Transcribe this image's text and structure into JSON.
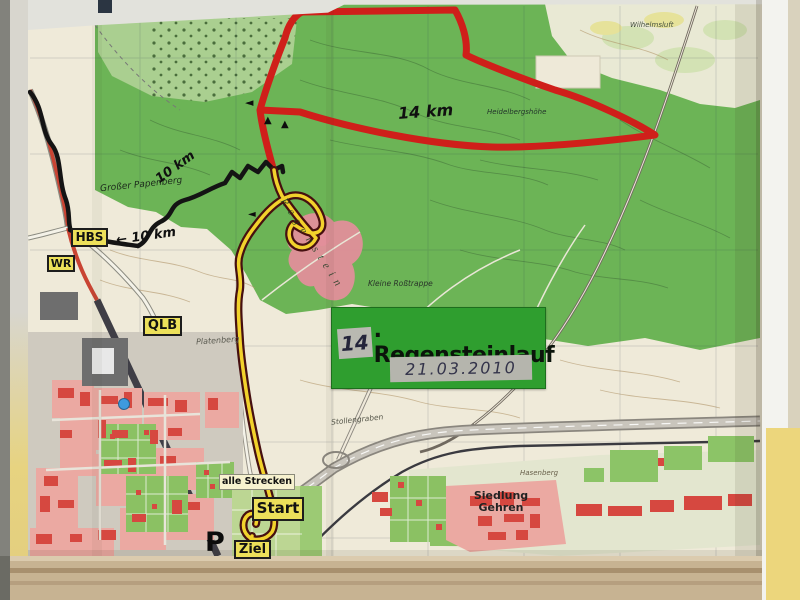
{
  "event_label": {
    "number": "14",
    "title_suffix": ". Regensteinlauf",
    "date": "21.03.2010"
  },
  "signs": {
    "hbs": "HBS",
    "wr": "WR",
    "qlb": "QLB",
    "alle_strecken": "alle Strecken",
    "start": "Start",
    "ziel": "Ziel",
    "parking": "P"
  },
  "route_annotations": {
    "km14": "14 km",
    "km10_upper": "10 km",
    "km10_lower": "← 10 km",
    "arrow_left": "◄",
    "arrow_up": "▲"
  },
  "place_labels": {
    "papenberg": "Großer Papenberg",
    "regenstein": "Regenstein",
    "rosstrappe": "Kleine Roßtrappe",
    "heidelbergshoehe": "Heidelbergshöhe",
    "platenberg": "Platenberg",
    "stollengraben": "Stollengraben",
    "siedlung_gehren_line1": "Siedlung",
    "siedlung_gehren_line2": "Gehren",
    "hasenberg": "Hasenberg",
    "wilhelmsluft": "Wilhelmsluft"
  },
  "colors": {
    "forest_green": "#6cb456",
    "light_green": "#aacf90",
    "map_cream": "#efead9",
    "route_red": "#cf1f1a",
    "route_black": "#141414",
    "route_yellow": "#f2d22c",
    "route_casing": "#461010",
    "sign_yellow": "#ece05a",
    "event_green": "#2f9e2f",
    "town_red": "#d64840",
    "town_pink": "#eba9a2",
    "rock_pink": "#e28f9a",
    "wall_yellow": "#e7d380",
    "ledge_tan": "#c7b392"
  }
}
